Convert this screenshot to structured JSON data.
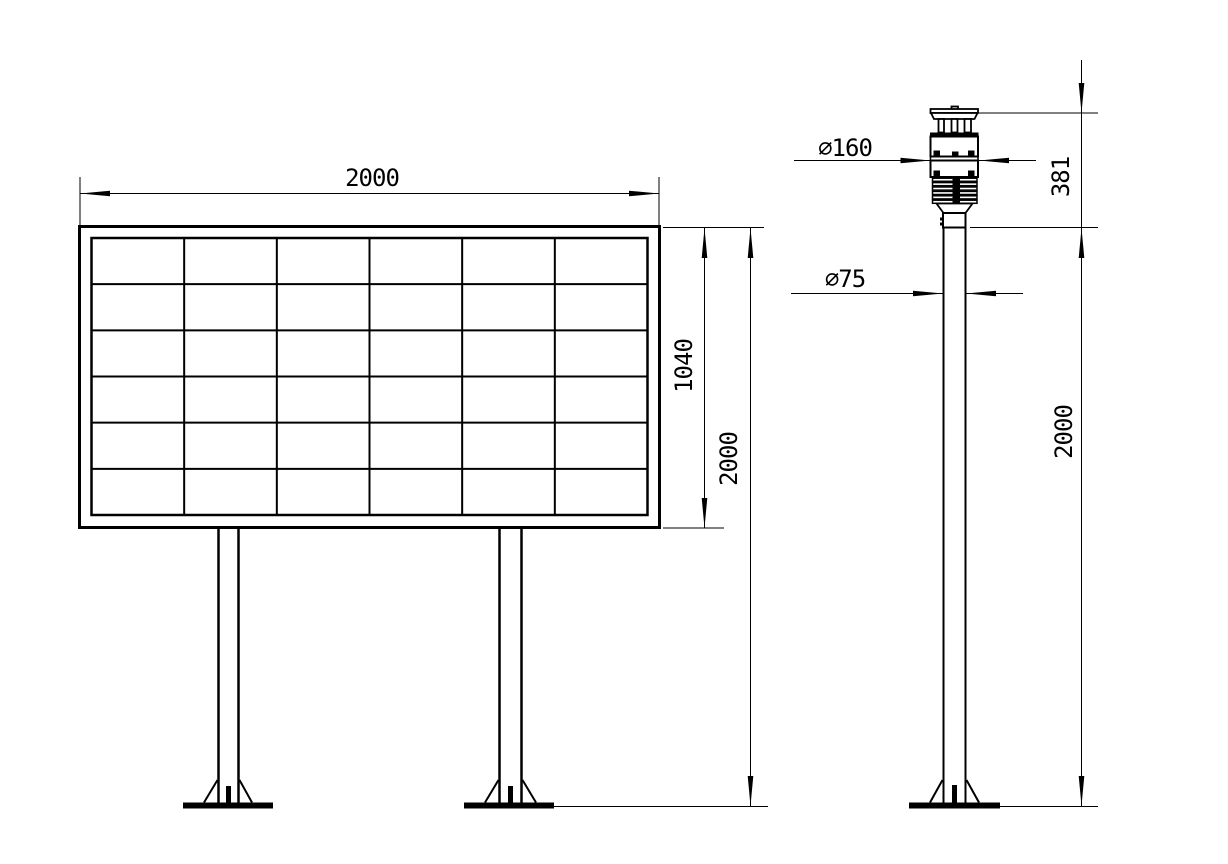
{
  "colors": {
    "line": "#000000",
    "background": "#ffffff"
  },
  "front_view": {
    "grid": {
      "rows": 6,
      "columns": 6
    },
    "dims": {
      "board_width": "2000",
      "board_height": "1040",
      "total_height": "2000"
    }
  },
  "side_view": {
    "dims": {
      "sensor_diameter": "∅160",
      "pole_diameter": "∅75",
      "sensor_height": "381",
      "pole_height": "2000"
    }
  }
}
